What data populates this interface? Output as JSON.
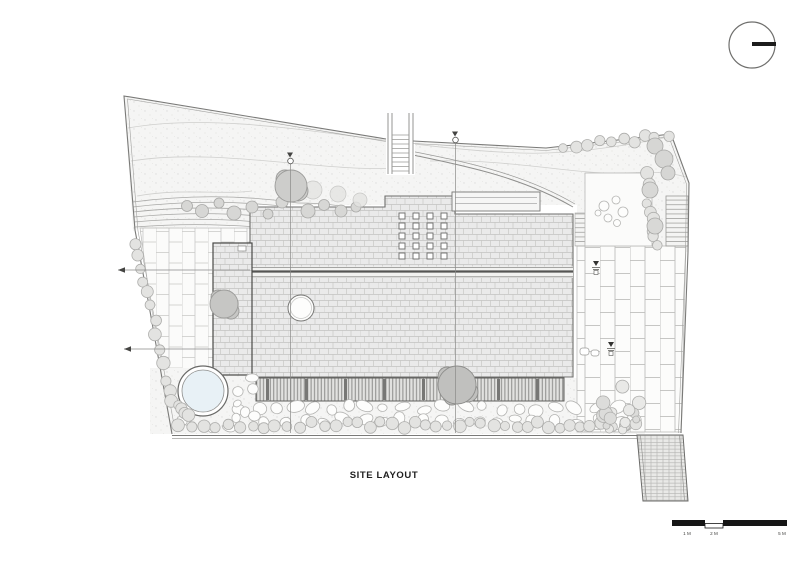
{
  "drawing": {
    "title": "SITE LAYOUT",
    "scale_bar": {
      "labels": [
        "1 M",
        "2 M",
        "5 M"
      ]
    },
    "colors": {
      "paper": "#ffffff",
      "ink": "#1f1f1f",
      "line_gray": "#8a8a88",
      "boundary_gray": "#7a7a78",
      "roof_fill": "#eaeaea",
      "tree_gray": "#cdcdcb",
      "shrub_gray": "#e3e3e1",
      "pool_blue": "#e8f1f6",
      "scalebar_black": "#161616"
    },
    "icons": {
      "north_indicator": "circle-with-bar"
    }
  }
}
